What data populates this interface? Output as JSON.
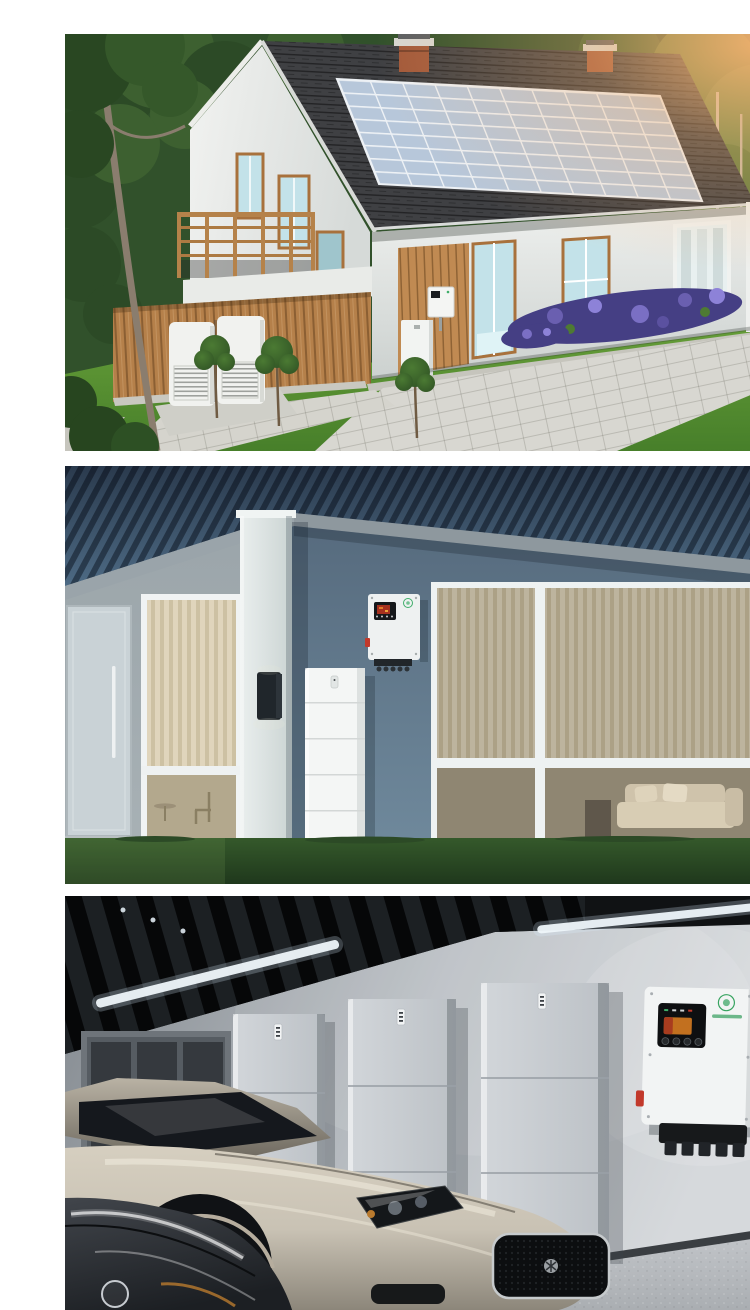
{
  "document": {
    "kind": "product-photo-collage",
    "visible_text": "none (brand logo on inverters is illegible)",
    "photo_count": 3
  },
  "photos": [
    {
      "name": "solar-house-exterior",
      "subject": "Two-story house at sunset with rooftop solar array, wall-mounted inverter, floor battery and twin outdoor heat-pump units",
      "solar_array": {
        "rows": 8,
        "cols": 10
      }
    },
    {
      "name": "modern-home-wall-system",
      "subject": "Modern single-story house at dusk with wall-mounted hybrid inverter and 5-module stacked battery tower on the lawn",
      "battery_modules": 5
    },
    {
      "name": "garage-storage-system",
      "subject": "Garage with three stacked battery cabinets, wall-mounted hybrid inverter and two sports cars",
      "battery_towers": 3,
      "vehicles": 2
    }
  ],
  "theme": {
    "foliage-dark": "#2c4a26",
    "foliage-mid": "#3d6030",
    "lawn-green": "#72aa3e",
    "lawn-deep": "#477f2a",
    "sun-flare": "#f7b371",
    "roof-shingle": "#3f4043",
    "solar-cell": "#b3c4d8",
    "solar-grid": "#edf1f5",
    "house-white": "#eef0ee",
    "wood-cladding": "#b5804a",
    "wood-frame": "#a8713c",
    "glass-teal": "#c3e2e9",
    "brick-red": "#a2593a",
    "gravel-gray": "#c6c5bd",
    "paver-gray": "#d8d7d1",
    "flower-purple": "#453f84",
    "unit-white": "#f1f2ef",
    "roof-blue-dark": "#2c3f52",
    "roof-blue-light": "#4d6a84",
    "fascia-gray": "#97a1a7",
    "wall-left-gray": "#a9b2b6",
    "wall-blue": "#64798c",
    "column-white": "#e3e9e9",
    "door-gray": "#c9d2d6",
    "interior-warm": "#d3c9b2",
    "grass-dark": "#2c4a26",
    "device-white": "#f2f4f4",
    "sconce-black": "#20262b",
    "garage-wall-dark": "#82888e",
    "garage-wall-light": "#d6d9dc",
    "ceiling-black": "#101214",
    "light-strip": "#eef5fa",
    "shelf-gray": "#6e747a",
    "battery-gray": "#c9cdd2",
    "floor-gray": "#b5b9bd",
    "car-champagne": "#c9c2b4",
    "car-dark-gray": "#2b2e33",
    "display-black": "#0e0f11",
    "screen-amber": "#c2701f",
    "logo-green": "#3fae6a",
    "connector-black": "#17191b",
    "dc-switch-red": "#c2392b"
  }
}
